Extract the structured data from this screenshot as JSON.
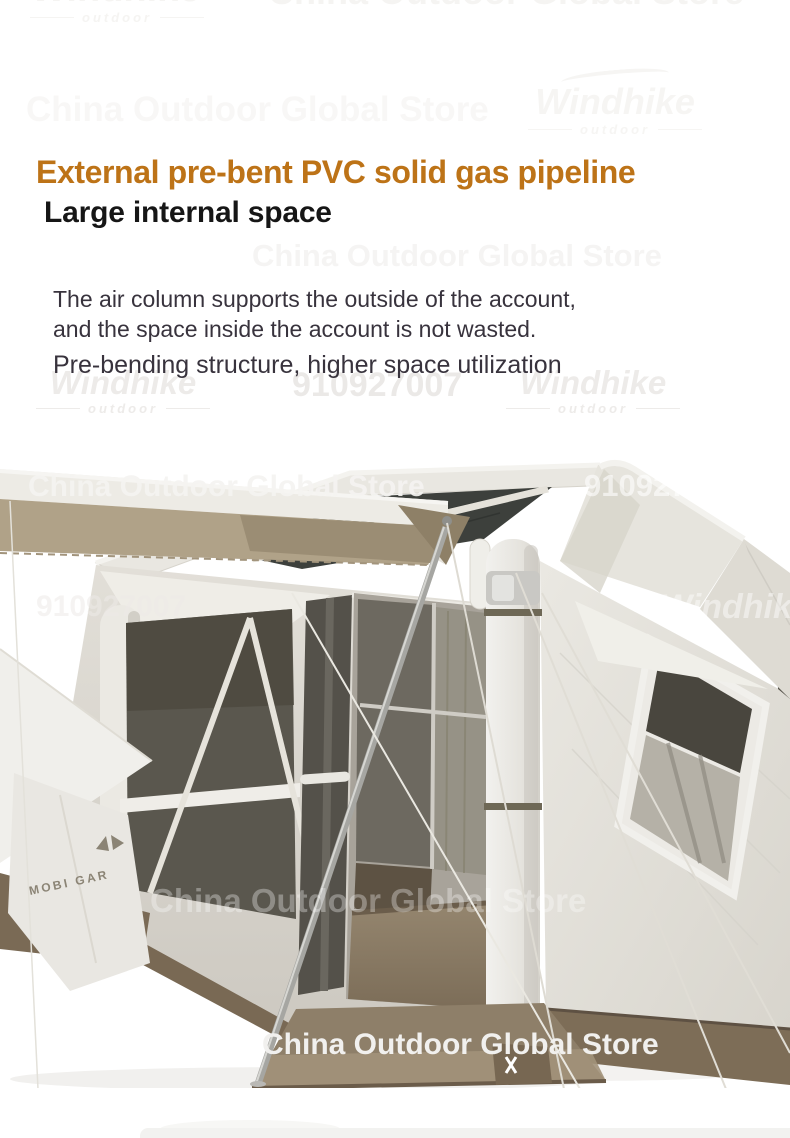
{
  "watermarks": {
    "brand": "Windhike",
    "brand_sub": "outdoor",
    "store": "China Outdoor Global Store",
    "store_id": "910927007"
  },
  "content": {
    "heading_primary": "External pre-bent PVC solid gas pipeline",
    "heading_secondary": "Large internal space",
    "body_line1": "The air column supports the outside of the account,",
    "body_line2": "and the space inside the account is not wasted.",
    "body_line3": "Pre-bending structure, higher space utilization"
  },
  "photo": {
    "brand_label": "MOBI GAR"
  },
  "colors": {
    "accent": "#bd7317",
    "heading": "#161616",
    "body_text": "#38333d",
    "fabric": "#e7e5df",
    "fabric_shade": "#cfccc4",
    "awning_underside": "#b0a288",
    "roof_mesh": "#3d403c",
    "window_mesh": "#57544b",
    "floor_brown": "#8b7c66",
    "skirt_brown": "#7a6a55"
  }
}
